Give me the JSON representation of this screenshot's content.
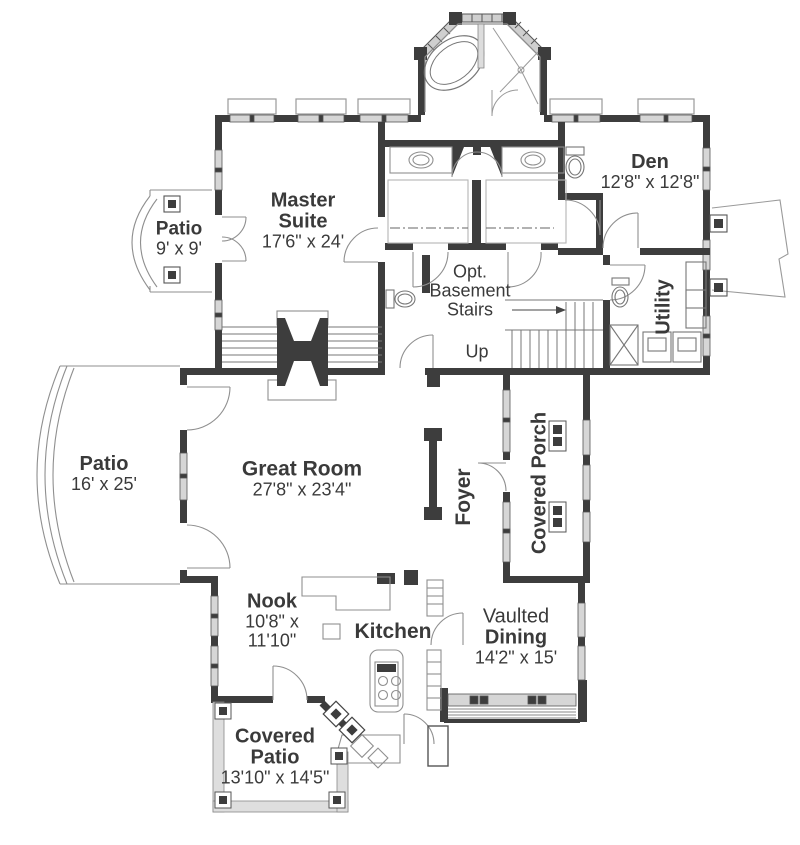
{
  "plan": {
    "colors": {
      "wall": "#3d3d3d",
      "text": "#3a3a3a",
      "window": "#d6d6d6"
    },
    "rooms": {
      "patio_small": {
        "name": "Patio",
        "dims": "9' x 9'"
      },
      "master_suite": {
        "name": "Master Suite",
        "dims": "17'6\" x 24'"
      },
      "den": {
        "name": "Den",
        "dims": "12'8\" x 12'8\""
      },
      "opt_basement": {
        "name": "Opt. Basement Stairs"
      },
      "stairs": {
        "up_label": "Up"
      },
      "utility": {
        "name": "Utility"
      },
      "patio_large": {
        "name": "Patio",
        "dims": "16' x 25'"
      },
      "great_room": {
        "name": "Great Room",
        "dims": "27'8\" x 23'4\""
      },
      "foyer": {
        "name": "Foyer"
      },
      "covered_porch": {
        "name": "Covered Porch"
      },
      "nook": {
        "name": "Nook",
        "dims": "10'8\" x 11'10\""
      },
      "kitchen": {
        "name": "Kitchen"
      },
      "dining": {
        "qualifier": "Vaulted",
        "name": "Dining",
        "dims": "14'2\" x 15'"
      },
      "covered_patio": {
        "name": "Covered Patio",
        "dims": "13'10\" x 14'5\""
      }
    }
  }
}
